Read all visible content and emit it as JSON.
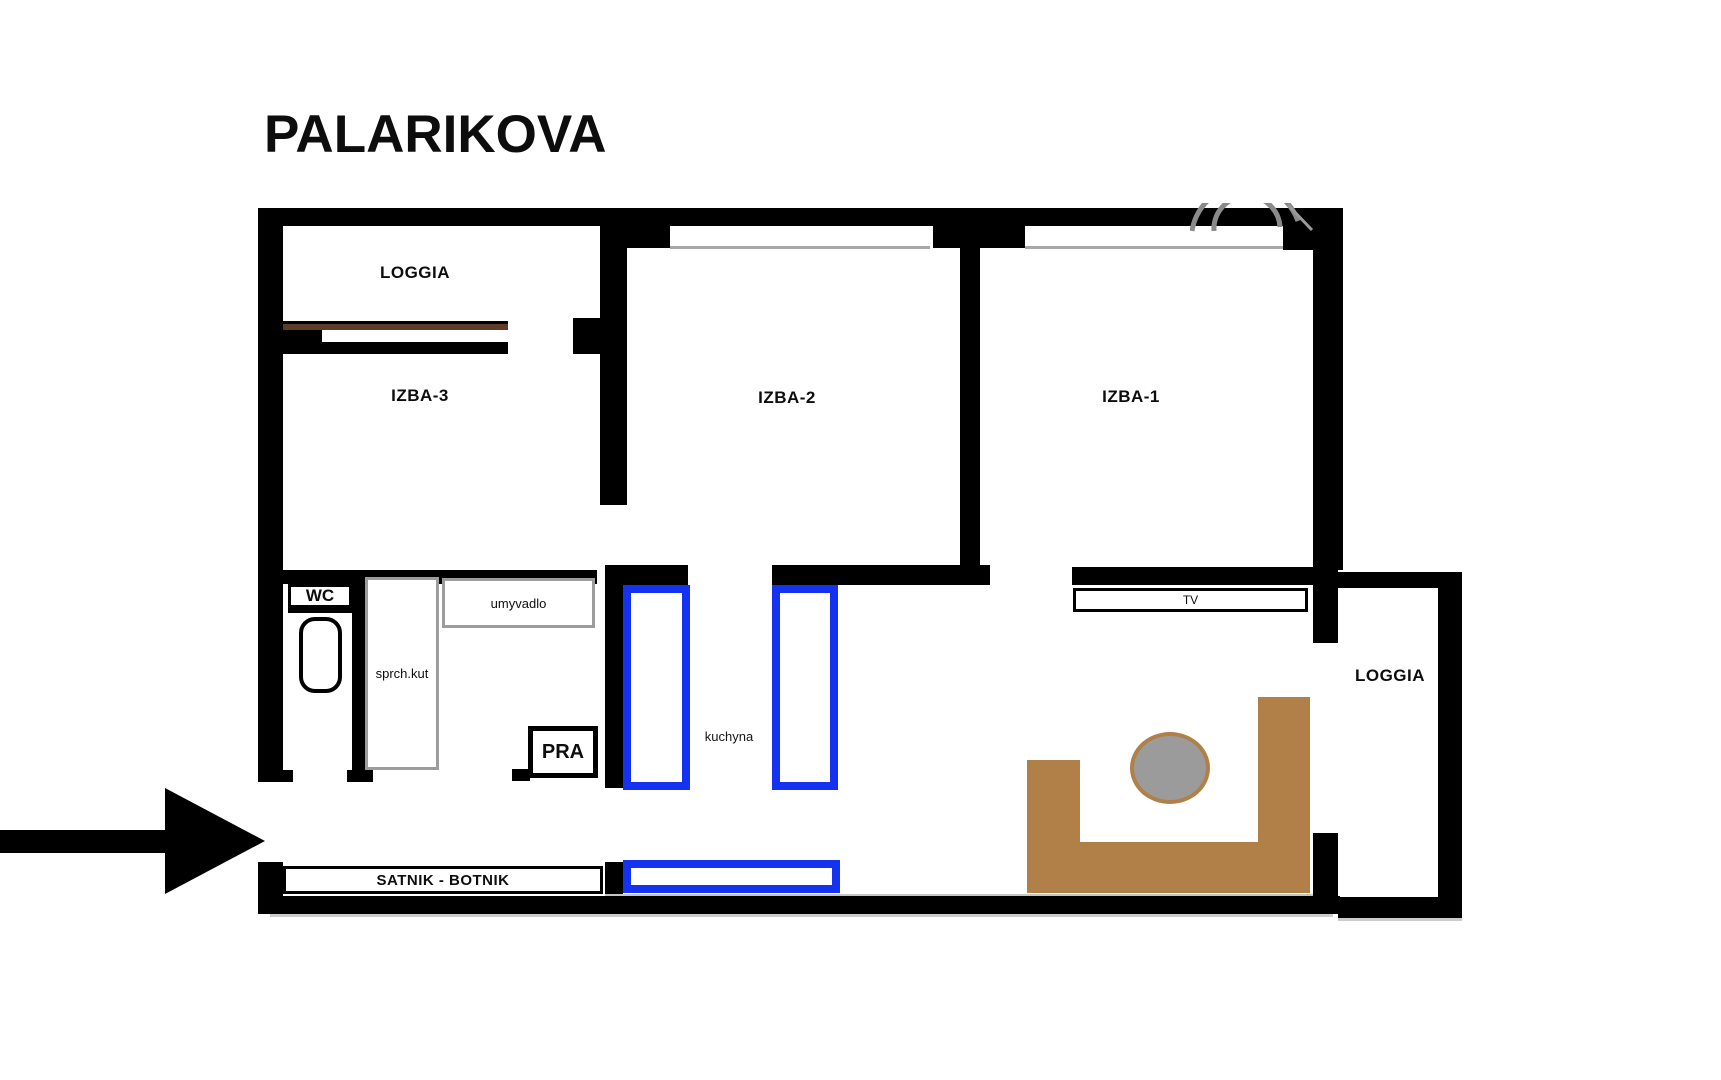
{
  "title": "PALARIKOVA",
  "rooms": {
    "loggia_top": "LOGGIA",
    "izba3": "IZBA-3",
    "izba2": "IZBA-2",
    "izba1": "IZBA-1",
    "kuchyna": "kuchyna",
    "loggia_right": "LOGGIA"
  },
  "fixtures": {
    "wc": "WC",
    "sprch_kut": "sprch.kut",
    "umyvadlo": "umyvadlo",
    "pra": "PRA",
    "satnik": "SATNIK - BOTNIK",
    "tv": "TV"
  },
  "colors": {
    "wall_black": "#000000",
    "counter_blue": "#1432f0",
    "sofa_brown": "#b08048",
    "table_gray": "#9b9b9b",
    "fixture_border_gray": "#9c9c9c",
    "window_sill_brown": "#5f3c28",
    "sill_line_gray": "#a8a8a8"
  }
}
